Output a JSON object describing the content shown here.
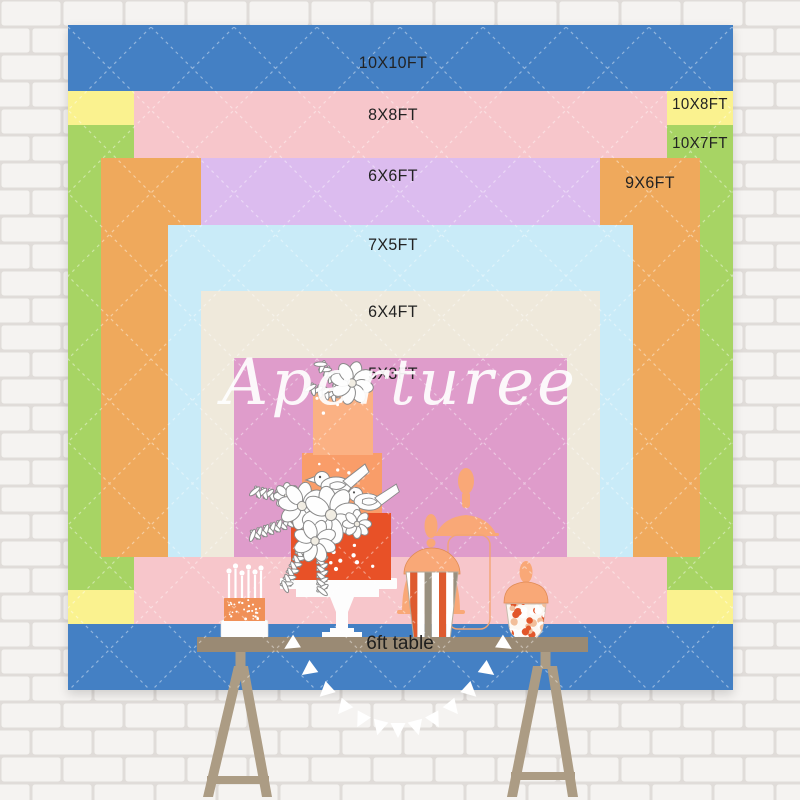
{
  "watermark": {
    "text": "Aperturee",
    "color": "#FFFFFF"
  },
  "backdrop": {
    "label_color": "#222222",
    "sizes": [
      {
        "id": "10x10ft",
        "label": "10X10FT",
        "color": "#4480C4"
      },
      {
        "id": "10x8ft",
        "label": "10X8FT",
        "color": "#FAF28F"
      },
      {
        "id": "10x7ft",
        "label": "10X7FT",
        "color": "#A7D464"
      },
      {
        "id": "8x8ft",
        "label": "8X8FT",
        "color": "#F7C6CB"
      },
      {
        "id": "9x6ft",
        "label": "9X6FT",
        "color": "#EFA95C"
      },
      {
        "id": "6x6ft",
        "label": "6X6FT",
        "color": "#DCBCEF"
      },
      {
        "id": "7x5ft",
        "label": "7X5FT",
        "color": "#C9EBF8"
      },
      {
        "id": "6x4ft",
        "label": "6X4FT",
        "color": "#EFE9DB"
      },
      {
        "id": "5x3ft",
        "label": "5X3FT",
        "color": "#DF9CCB"
      }
    ]
  },
  "table": {
    "label": "6ft table",
    "label_color": "#1E1E1E",
    "top_color": "#9A8A74",
    "leg_color": "#AC9C84"
  },
  "illustration": {
    "cake_tier_colors": [
      "#FBB183",
      "#F99D69",
      "#E85127"
    ],
    "small_cake_color": "#F09057",
    "silhouette_color": "#F9A877",
    "bunting_color": "#FFFFFF",
    "stripe_colors": [
      "#DE5B2F",
      "#99907F",
      "#FFFFFF"
    ],
    "confetti_colors": [
      "#E2572B",
      "#FFFFFF",
      "#F2BE9A"
    ],
    "outline_color": "#8A8A8A"
  },
  "wall": {
    "brick_color": "#F3F1EE",
    "mortar_color": "#D9D5D1"
  }
}
